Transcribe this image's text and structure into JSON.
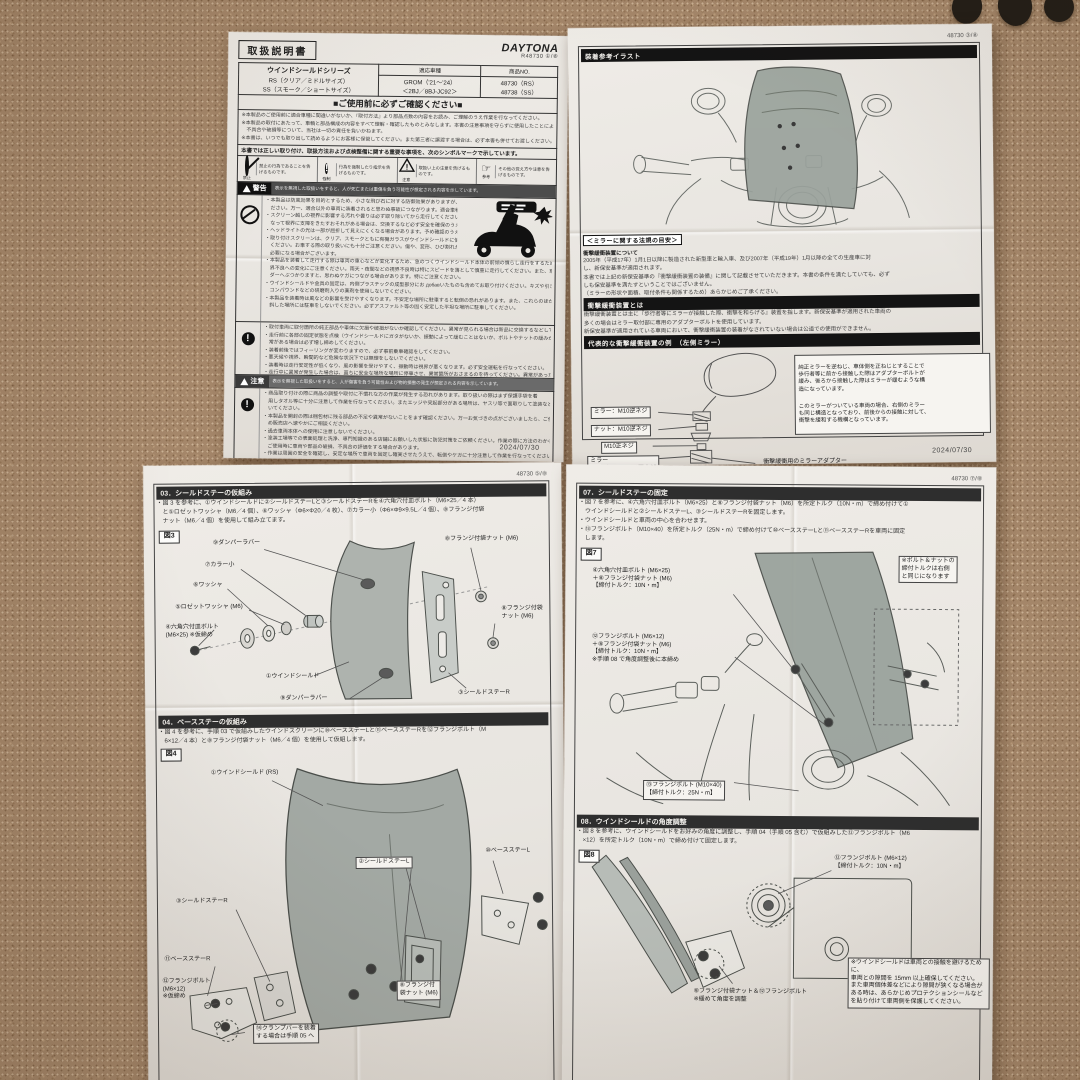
{
  "icons": {
    "exclaim": "!",
    "hand": "☞",
    "warn_mark": "!"
  },
  "page1": {
    "pageno": "R48730 ①/⑧",
    "doc_title": "取扱説明書",
    "brand": "DAYTONA",
    "product": {
      "series": "ウインドシールドシリーズ",
      "rs": "RS（クリア／ミドルサイズ）",
      "ss": "SS（スモーク／ショートサイズ）",
      "fit_header": "適応車種",
      "fit_model": "GROM（'21～'24）",
      "fit_code": "＜2BJ／8BJ-JC92＞",
      "no_header": "商品NO.",
      "no_rs": "48730（RS）",
      "no_ss": "48738（SS）"
    },
    "confirm_bar": "■ご使用前に必ずご確認ください■",
    "intro_lines": [
      "※本製品のご使用前に適合車種に間違いがないか、『取付方法』より部品点数の内容をお読み、ご理解のうえ作業を行なってください。",
      "※本製品の取付にあたって、車輌と部品構成の内容をすべて理解・確認したものとみなします。本書の注意事項を守らずに使用したことによる",
      "　不具合や破損等について、当社は一切の責任を負いかねます。",
      "※本書は、いつでも取り出して読めるようにお客様に保管してください。また第三者に譲渡する場合は、必ず本書も併せてお渡しください。"
    ],
    "legend_intro": "本書では正しい取り付け、取扱方法および点検整備に関する重要な事項を、次のシンボルマークで示しています。",
    "legend": [
      {
        "cap": "禁止",
        "text": "禁止の行為であることを告げるものです。"
      },
      {
        "cap": "強制",
        "text": "行為を強制したり指示を告げるものです。"
      },
      {
        "cap": "注意",
        "text": "取扱い上の注意を告げるものです。"
      },
      {
        "cap": "参考",
        "text": "その他の覚え方や注意を告げるものです。"
      }
    ],
    "warn_title": "警告",
    "warn_bar": "表示を無視した取扱いをすると、人が死亡または重傷を負う可能性が想定される内容を示しています。",
    "warn_lines": [
      "・本製品は防風効果を目的とするため、小さな飛び石に対する防御効果がありますが、そのためのご使用はお守りく",
      "　ださい。万一、適合以外の車両に装着されると思わぬ事故につながります。適合車種の純正部品のままご使用ください。",
      "・スクリーン越しの視界に影響する汚れや曇りは必ず取り除いてから走行してください。ウインドシールドに傷が付いて見えにくく",
      "　なって視界に支障をきたすおそれがある場合は、交換するなど必ず安全を確保のうえご使用ください。",
      "・ヘッドライトの光は一部が屈折して見えにくくなる場合があります。予め確認のうえ夜間走行には十分ご注意ください。",
      "・取り付けスクリーンは、クリア、スモークともに有機ガラスがウインドシールドに使用されていますので、",
      "　ください。お車する際の取り扱いにも十分ご注意ください。傷や、変形、ひび割れが発生しますと、お客様ご自身による交換が",
      "　必要になる場合がございます。",
      "・本製品を装着して走行する際は車両の重心などが変化するため、急のつくウインドシールド本体の前傾の慣らし走行をするため、前方の視",
      "　界不良への変化にご注意ください。雨天・夜間などの視界不良時は特にスピードを落として慎重に走行してください。また、車両本体を保持するための装備をせずにライ",
      "　ダーへぶつかりますと、思わぬケガにつながる場合があります。特にご注意ください。",
      "・ウインドシールドや金具の固定は、内側プラスチックの成型部分にお добавいたものも含めてお取り付けください。キズや引き傷等が付くのを防ぎます。また、",
      "　コンパウンドなどの研磨剤入りの薬剤を使用しないでください。",
      "・本製品を装着時は風などの影響を受けやすくなります。不安定な場所に駐車すると転倒の恐れがあります。また、これらのほか路面の柔らかい場所や傾",
      "　斜した場所には駐車をしないでください。必ずアスファルト等の固く安定した平坦な場所に駐車してください。"
    ],
    "mand_lines": [
      "・取付車両に取付箇所の純正部品や車体に欠損や破損がないか確認してください。異常が見られる場合は新品に交換するなどしてください。",
      "・走行前に各部の固定状態を点検（ウインドシールドにガタがないか、振動によって緩むことはないか、ボルトやナットの緩みがないか）し、異",
      "　常がある場合は必ず増し締めしてください。",
      "・装着前後ではフィーリングが変わりますので、必ず事前乗車確認をしてください。",
      "・悪天候や視界、瞬間的など危険な状況下では無理をしないでください。",
      "・装着時は走行安定性が低くなり、風の影響を受けやすく、振動時は視界が悪くなります。必ず安全運転を行なってください。",
      "・走行中に異常が発生した場合は、直ちに安全な場所な場所に停車させ、異常箇所がおさまるのを待ってください。異常があった場合は、商品の使用を",
      "　その時点の状態を中止し、最寄工場や販売店へご相談してください。"
    ],
    "caution_title": "注意",
    "caution_bar": "表示を無視した取扱いをすると、人が傷害を負う可能性および物的損害の発生が想定される内容を示しています。",
    "caution_lines": [
      "・商品取り付けの際に商品の調整や取付に不慣れな方の作業が発生する恐れがあります。取り扱いの際はまず保護手袋を着",
      "　用しタオル等に十分に注意して作業を行なってください。またエッジや突起部分がある場所は、ヤスリ等で面取りして塗装など処理を行ない、取り扱",
      "　いてください。",
      "・本製品を開封の際は梱包材に残る部品の不足や異常がないことをまず確認ください。万一お気づきの点がございましたら、ご使用前にお買い求",
      "　め販売店へ速やかにご相談ください。",
      "・過去車両本体への使用に注意しないでください。",
      "・塗装工場等での表面処理と洗浄、専門知識のある店舗にお願いした状態に防犯対策をご依頼ください。作業の際に方法のわからないこと、作業がや",
      "　ご使用時に車両や部品の破損、不具合の評価をする場合があります。",
      "・作業は周囲の安全を確認し、安定な場所で車両を固定し確実させたうえで、転倒やケガに十分注意して作業を行なってください。",
      "・本製品を取り付ける際は、車両にキズが付かないようにウエス等などで保護してから作業してください。",
      "・取り付けは説明書に記載した工具をご使用ください。不適切な工具を使用すると部品の破損やケガをする可能性があります。",
      "・本製品を取り付ける際には所定トルクで確実に締め付けてください。特にウインドシールドを固定される際はオーバートルクに注意して取り付",
      "　けてください。締め付けすぎるとウインドシールドの破損や変形の原因となる場合がございます。",
      "・本製品を取り付けると純正ミラーの位置がオフセットされます。視界に異常が確認できるようにミラーの調整をしてください。",
      "・取り付け後 100km 走行しましたら各部やネジの緩み・増し締め等、必要に応じてネジの締め直しを行なってください。その後は 500km 毎に点",
      "　検締め作業を行なってください。",
      "・ハンドルを左右へ切った際に、ウインドシールドが車体に接触しないか確認してください。また同時にブレーキレバーやスロットルが正常に作",
      "　動することを確認してください。異常がある場合は取り付け位置を調整してください。",
      "・寒冷カバーを使用する場合は、ウインドシールドは使用中のカバーを併用し、高温は光が当たらない風通しの良い場所に駐車してください。",
      "・サイズのあわないカバーを無理に使用するとウインドシールドが変形する原因になります。また、高温下で使用した場合もカバー跡が付く原因と",
      "　なり、ウインドシールドの変形の原因となります。ご注意ください。"
    ],
    "date": "2024/07/30"
  },
  "page2": {
    "pageno": "48730 ③/⑧",
    "bar_illust": "装着参考イラスト",
    "legal_title": "＜ミラーに関する法規の目安＞",
    "sub1": "衝撃緩衝装置について",
    "para1": [
      "2005年（平成17年）1月1日以降に製造された新型車と輸入車、及び2007年（平成19年）1月以降の全ての生産車に対",
      "し、新保安基準が適用されます。",
      "本書では上記の新保安基準の『衝撃緩衝装置の装備』に関して記載させていただきます。本書の条件を満たしていても、必ず",
      "しも保安基準を満たすということではございません。",
      "（ミラーの形状や面積、取付条件も関係するため）あらかじめご了承ください。"
    ],
    "bar2": "衝撃緩衝装置とは",
    "para2": [
      "衝撃緩衝装置とは主に『歩行者等にミラーが接触した際、衝撃を和らげる』装置を指します。新保安基準が適用された車両の",
      "多くの場合はミラー取付部に専用のアダプターボルトを使用しています。",
      "新保安基準が適用されている車両において、衝撃緩衝装置の装着がなされていない場合は公道での使用ができません。"
    ],
    "bar3": "代表的な衝撃緩衝装置の例　（左側ミラー）",
    "mirror_labels": [
      "ミラー：M10逆ネジ",
      "ナット：M10逆ネジ",
      "M10正ネジ",
      "ミラー\nアダプター：M10正ネジ"
    ],
    "adapter_label": "衝撃緩衝用のミラーアダプター",
    "mirror_note1": "純正ミラーを逆ねじ、車体側を正ねじとすることで\n歩行者等に前から接触した際はアダプターボルトが\n緩み、後ろから接触した際はミラーが緩むような構\n造になっています。",
    "mirror_note2": "このミラーがついている車両の場合、右側のミラー\nも同じ構造となっており、前後からの接触に対して、\n衝撃を緩和する機構となっています。",
    "bar4": "ミラー及び衝撃緩衝装置の取り扱いについて",
    "para3": [
      "弊社で販売をさせていただいている商品の中で、『純正の取付位置よりミラーの位置を変更する』商品がございます。",
      "純正ミラーの位置より変更する際は、必ず衝撃緩衝装置（アダプターボルト）も一緒に移動させてください。",
      "また、ミラー及びアダプターボルトの取り外しの際は正ねじ、逆ねじに注意してください。"
    ],
    "date": "2024/07/30"
  },
  "page3": {
    "pageno": "48730 ⑤/⑧",
    "sec03_title": "03．シールドステーの仮組み",
    "sec03_lines": [
      "・図 3 を参考に、①ウインドシールドに②シールドステーLと③シールドステーRを④六角穴付皿ボルト（M6×25／4 本）",
      "　と⑤ロゼットワッシャ（M6／4 個）、⑥ワッシャ（Φ6×Φ20／4 枚）、⑦カラー小（Φ6×Φ9×9.5L／4 個）、⑧フランジ付袋",
      "　ナット（M6／4 個）を使用して組み立てます。"
    ],
    "fig3_tag": "図3",
    "fig3_labels": [
      "⑨ダンパーラバー",
      "⑦カラー小",
      "⑥ワッシャ",
      "⑤ロゼットワッシャ (M6)",
      "④六角穴付皿ボルト\n(M6×25) ※仮締め",
      "①ウインドシールド",
      "⑨ダンパーラバー",
      "⑧フランジ付袋ナット (M6)",
      "⑧フランジ付袋\nナット (M6)",
      "③シールドステーR"
    ],
    "sec04_title": "04．ベースステーの仮組み",
    "sec04_lines": [
      "・図 4 を参考に、手順 03 で仮組みしたウインドスクリーンに⑩ベースステーLと⑪ベースステーRを⑫フランジボルト（M",
      "　6×12／4 本）と⑧フランジ付袋ナット（M6／4 個）を使用して仮組します。"
    ],
    "fig4_tag": "図4",
    "fig4_labels": [
      "①ウインドシールド (RS)",
      "②シールドステーL",
      "⑩ベースステーL",
      "③シールドステーR",
      "⑪ベースステーR",
      "⑫フランジボルト\n(M6×12)\n※仮締め",
      "⑧フランジ付\n袋ナット (M6)",
      "⑭クランプバーを装着\nする場合は手順 05 へ"
    ],
    "date": "2024/07/30"
  },
  "page4": {
    "pageno": "48730 ⑦/⑧",
    "sec07_title": "07．シールドステーの固定",
    "sec07_lines": [
      "・図 7 を参考に、④六角穴付皿ボルト（M6×25）と⑧フランジ付袋ナット（M6）を所定トルク（10N・m）で締め付けて①",
      "　ウインドシールドと②シールドステーL、③シールドステーRを固定します。",
      "・ウインドシールドと車両の中心を合わせます。",
      "・⑬フランジボルト（M10×40）を所定トルク（25N・m）で締め付けて⑩ベースステーLと⑪ベースステーRを車両に固定",
      "　します。"
    ],
    "fig7_tag": "図7",
    "fig7_labels": [
      "④六角穴付皿ボルト (M6×25)\n＋⑧フランジ付袋ナット (M6)\n【締付トルク：10N・m】",
      "⑫フランジボルト (M6×12)\n＋⑧フランジ付袋ナット (M6)\n【締付トルク：10N・m】\n※手順 08 で角度調整後に本締め",
      "⑬フランジボルト (M10×40)\n【締付トルク：25N・m】"
    ],
    "fig7_note": "※ボルト＆ナットの\n締付トルクは右側\nと同じになります",
    "sec08_title": "08．ウインドシールドの角度調整",
    "sec08_lines": [
      "・図 8 を参考に、ウインドシールドをお好みの角度に調整し、手順 04（手順 05 含む）で仮組みした⑫フランジボルト（M6",
      "　×12）を所定トルク（10N・m）で締め付けて固定します。"
    ],
    "fig8_tag": "図8",
    "fig8_labels": [
      "⑫フランジボルト (M6×12)\n【締付トルク：10N・m】",
      "⑧フランジ付袋ナット＆⑫フランジボルト\n※緩めて角度を調整"
    ],
    "fig8_note": "※ウインドシールドは車両との接触を避けるために、\n車両との隙間を 15mm 以上確保してください。\nまた車両個体差などにより隙間が狭くなる場合が\nある時は、あらかじめプロテクションシールなど\nを貼り付けて車両側を保護してください。",
    "date": "2024/07/30"
  }
}
